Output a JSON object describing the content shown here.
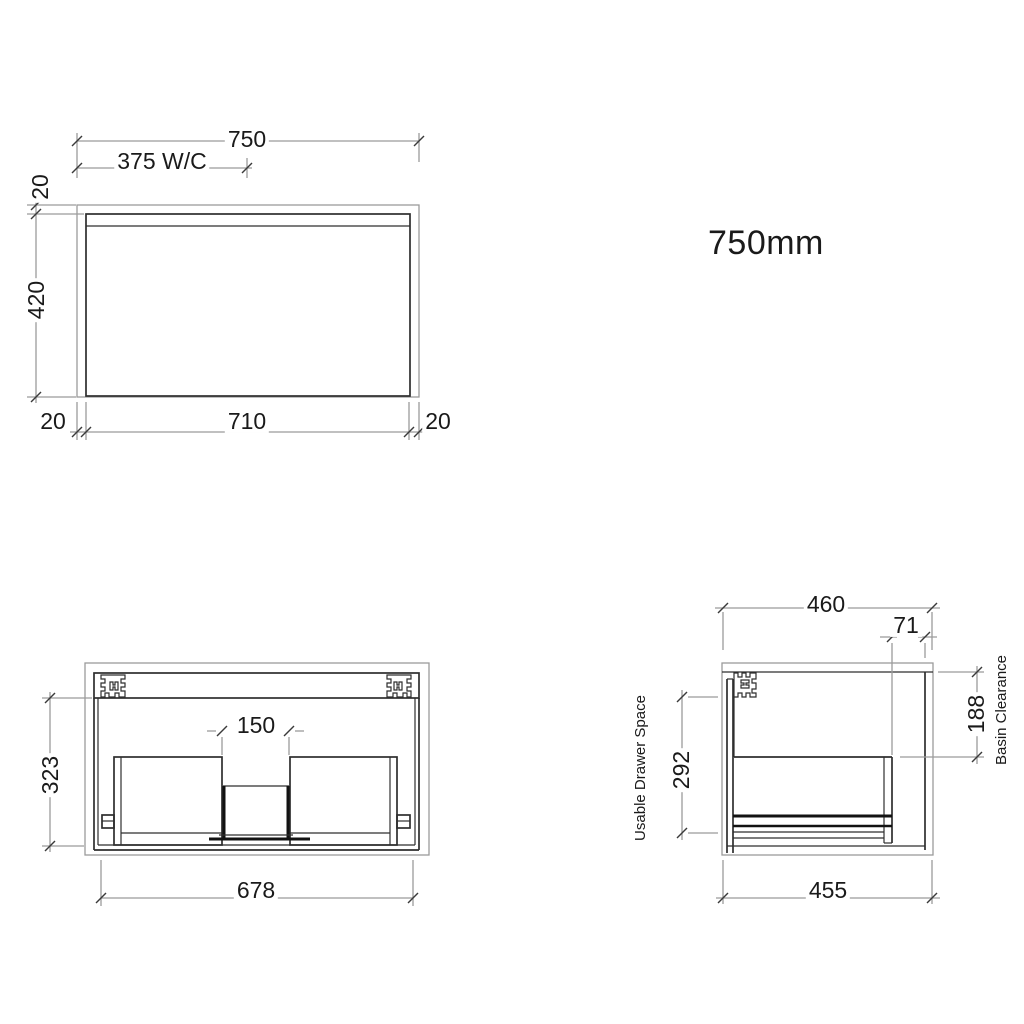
{
  "colors": {
    "background": "#ffffff",
    "line_dark": "#2e2e2e",
    "line_light": "#9b9b9b",
    "text": "#1a1a1a"
  },
  "title": {
    "text": "750mm"
  },
  "front_view": {
    "dims": {
      "overall_width": "750",
      "wc_offset": "375 W/C",
      "top_thickness": "20",
      "height": "420",
      "bottom_left_reveal": "20",
      "bottom_width": "710",
      "bottom_right_reveal": "20"
    }
  },
  "open_view": {
    "dims": {
      "internal_height": "323",
      "center_gap": "150",
      "internal_width": "678"
    }
  },
  "side_view": {
    "dims": {
      "depth": "460",
      "back_clearance": "71",
      "basin_clearance": "188",
      "drawer_space": "292",
      "bottom_depth": "455"
    },
    "labels": {
      "drawer_space": "Usable Drawer Space",
      "basin_clearance": "Basin Clearance"
    }
  }
}
